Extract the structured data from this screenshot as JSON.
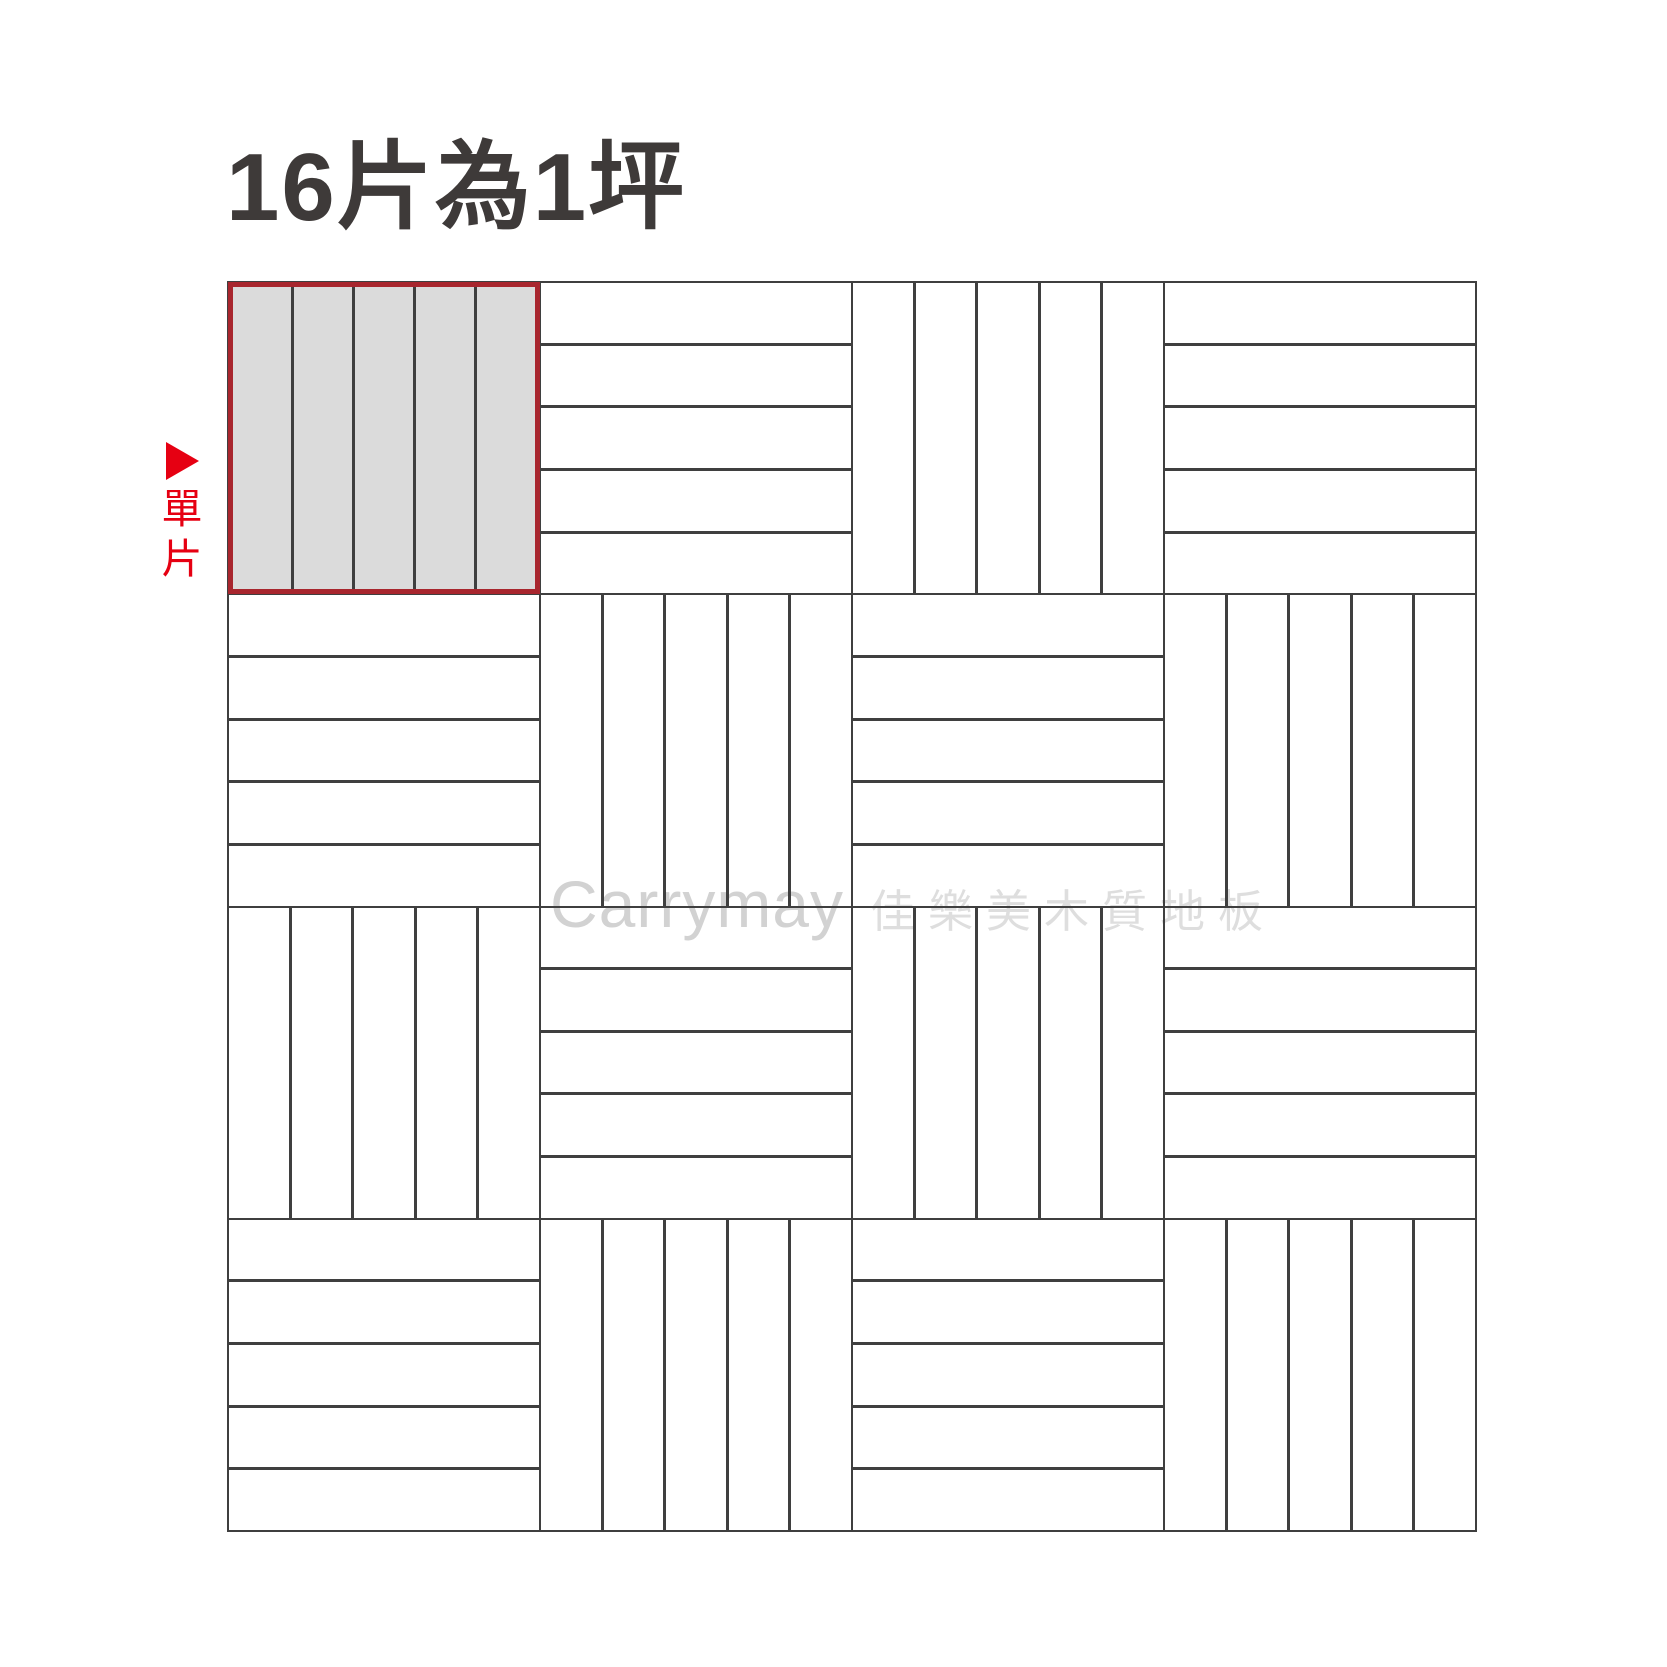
{
  "title": "16片為1坪",
  "annotation": {
    "arrow_icon": "right-pointing-triangle",
    "label": "單片"
  },
  "watermark": {
    "latin": "Carrymay",
    "chinese": "佳樂美木質地板"
  },
  "colors": {
    "accent_red": "#e60012",
    "highlight_border": "#a8262e",
    "highlight_fill": "#dbdbdb",
    "grid_line": "#3f3f3f",
    "title_text": "#3e3a39",
    "watermark_latin": "#d2d2d2",
    "watermark_cjk": "#dedede"
  },
  "grid": {
    "rows": 4,
    "cols": 4,
    "strips_per_tile": 5,
    "total_tiles": 16,
    "tiles": [
      {
        "row": 1,
        "col": 1,
        "orientation": "vertical",
        "highlighted": true
      },
      {
        "row": 1,
        "col": 2,
        "orientation": "horizontal",
        "highlighted": false
      },
      {
        "row": 1,
        "col": 3,
        "orientation": "vertical",
        "highlighted": false
      },
      {
        "row": 1,
        "col": 4,
        "orientation": "horizontal",
        "highlighted": false
      },
      {
        "row": 2,
        "col": 1,
        "orientation": "horizontal",
        "highlighted": false
      },
      {
        "row": 2,
        "col": 2,
        "orientation": "vertical",
        "highlighted": false
      },
      {
        "row": 2,
        "col": 3,
        "orientation": "horizontal",
        "highlighted": false
      },
      {
        "row": 2,
        "col": 4,
        "orientation": "vertical",
        "highlighted": false
      },
      {
        "row": 3,
        "col": 1,
        "orientation": "vertical",
        "highlighted": false
      },
      {
        "row": 3,
        "col": 2,
        "orientation": "horizontal",
        "highlighted": false
      },
      {
        "row": 3,
        "col": 3,
        "orientation": "vertical",
        "highlighted": false
      },
      {
        "row": 3,
        "col": 4,
        "orientation": "horizontal",
        "highlighted": false
      },
      {
        "row": 4,
        "col": 1,
        "orientation": "horizontal",
        "highlighted": false
      },
      {
        "row": 4,
        "col": 2,
        "orientation": "vertical",
        "highlighted": false
      },
      {
        "row": 4,
        "col": 3,
        "orientation": "horizontal",
        "highlighted": false
      },
      {
        "row": 4,
        "col": 4,
        "orientation": "vertical",
        "highlighted": false
      }
    ]
  }
}
